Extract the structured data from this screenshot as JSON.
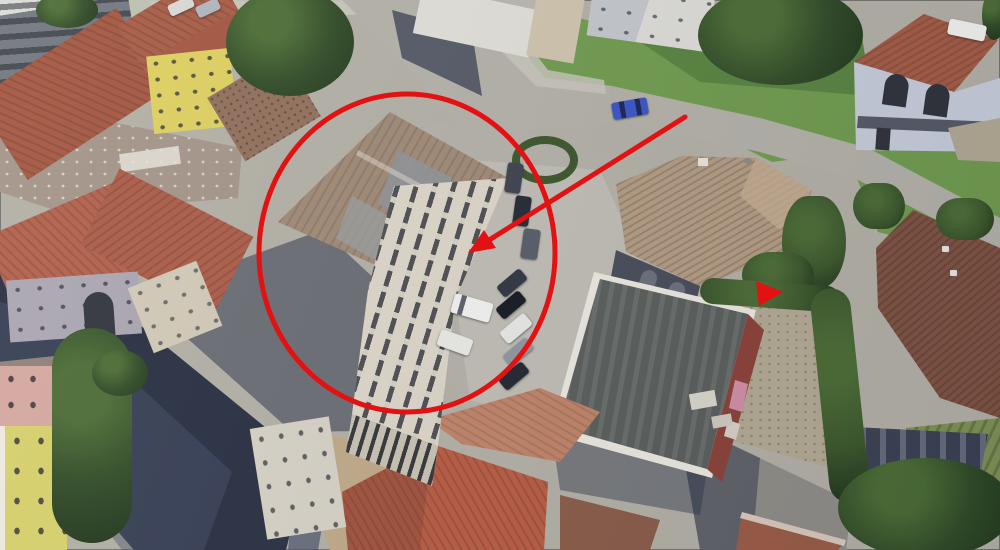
{
  "image": {
    "kind": "aerial-3d-satellite-photo",
    "width": 1000,
    "height": 550,
    "description": "Oblique Google-Earth-style aerial view of a small town block with terracotta-roofed houses, roads, lawns and a parking area. A red ellipse and a red arrow highlight a three-storey cream building with a large tan hip roof beside the parking lot; a small red triangular marker sits near a gateway east of the parking, next to a flat-roofed warehouse."
  },
  "annotations": {
    "accent_color": "#e31112",
    "ellipse": {
      "cx": 407,
      "cy": 253,
      "rx": 148,
      "ry": 159,
      "stroke_width": 5
    },
    "arrow": {
      "tail_x": 685,
      "tail_y": 117,
      "shaft_end_x": 486,
      "shaft_end_y": 242,
      "stroke_width": 5,
      "head_points": "468,253 484,230 496,248"
    },
    "marker": {
      "points": "756,281 783,292 759,306"
    }
  },
  "palette": {
    "ground": "#b2afa4",
    "asphalt": "#b3b0a7",
    "asphaltLight": "#c9c6bd",
    "asphaltDark": "#8e8c85",
    "shadowRoad": "#262d3f",
    "shadowSoft": "#47506a",
    "shadow": "#2b3347",
    "grass": "#6f9a4c",
    "grassDark": "#4f7a38",
    "gardenGreen": "#7d9152",
    "tree": "#2f4a24",
    "treeDark": "#1f3419",
    "treeLight": "#4a6b33",
    "hedge": "#3a5529",
    "roofRed": "#a2543e",
    "roofOrange": "#b85a40",
    "roofSalmon": "#c08266",
    "roofBrown": "#7e5140",
    "roofTan": "#9e8873",
    "roofHouseTan": "#b29b82",
    "villaRoof": "#a35a43",
    "facadeWhite": "#e0ded7",
    "facadeCream": "#dcd6c7",
    "facadeYellow": "#ddcf5e",
    "facadePink": "#d5a79e",
    "facadeLavender": "#aaa5b0",
    "facadeBlue": "#c6ccd9",
    "warehouseRoof": "#585d5a",
    "warehouseRim": "#ebe8de",
    "brick": "#8a4036",
    "dirt": "#bfa886",
    "gravel": "#b2a892",
    "window": "#2c2f36",
    "carWhite": "#f2f2ee",
    "carBlue": "#3a53c4"
  }
}
